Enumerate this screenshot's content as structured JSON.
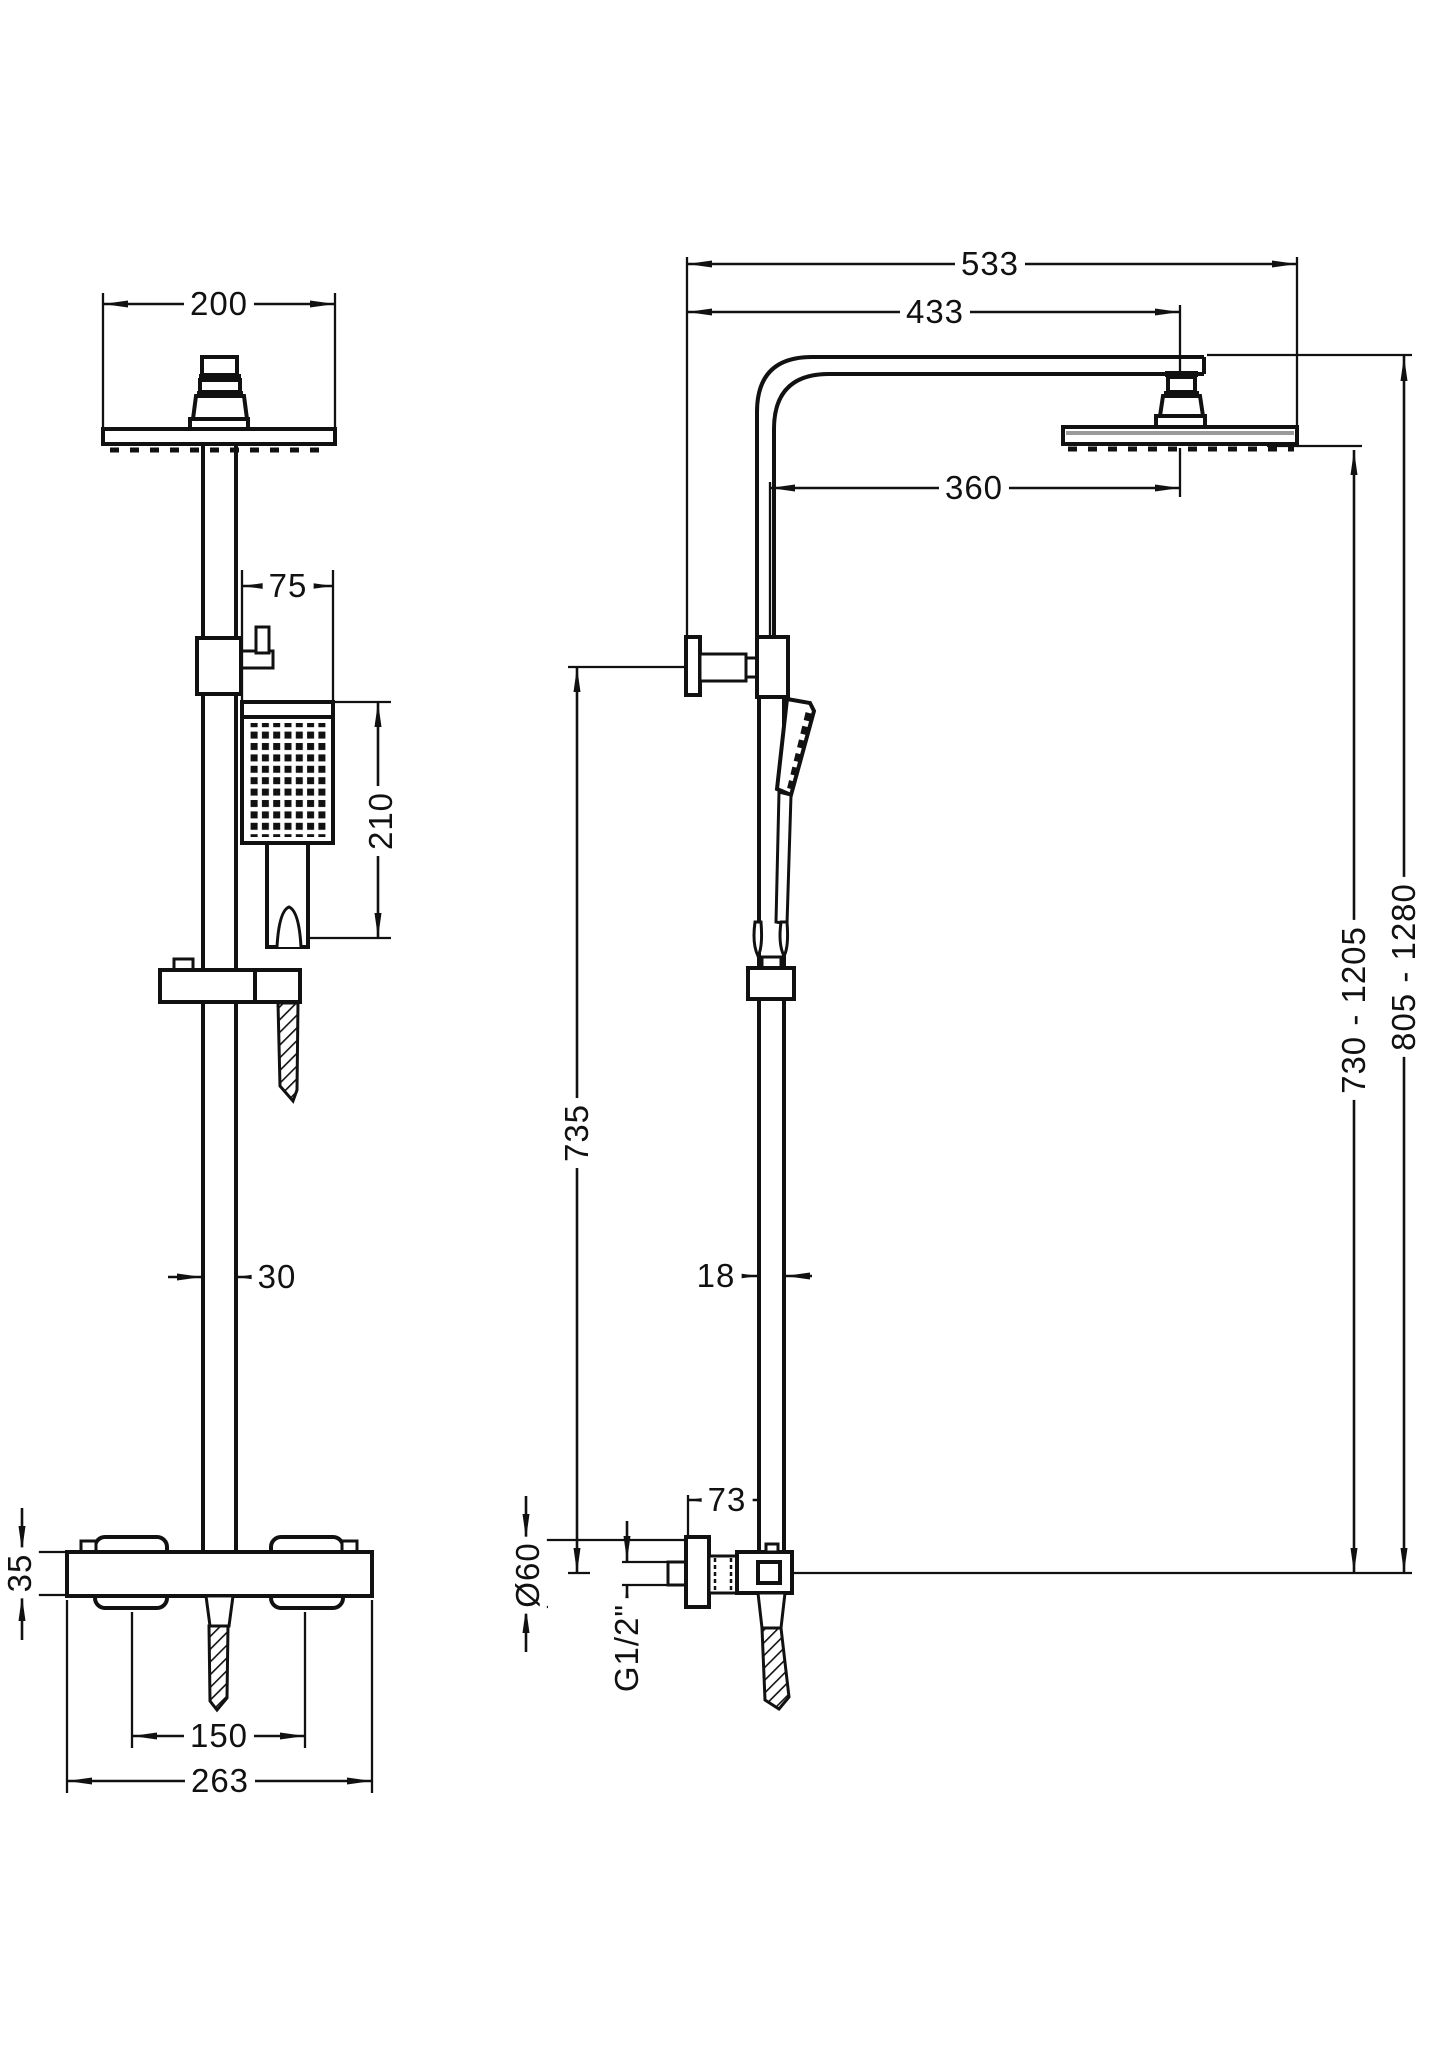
{
  "page": {
    "background": "#ffffff",
    "line_color": "#111111"
  },
  "views": {
    "front": {
      "title": "front-elevation",
      "dims": {
        "head_width": "200",
        "handset_head_width": "75",
        "handset_length": "210",
        "rail_width": "30",
        "valve_body_height": "35",
        "handle_centres": "150",
        "valve_overall_width": "263"
      }
    },
    "side": {
      "title": "side-elevation",
      "dims": {
        "overall_reach": "533",
        "reach_to_head_centre": "433",
        "rail_to_head_centre": "360",
        "bracket_to_valve_centre": "735",
        "rail_depth": "18",
        "wall_to_rail": "73",
        "flange_diameter": "Ø60",
        "inlet_thread": "G1/2\"",
        "valve_to_head_face_range": "730 - 1205",
        "valve_to_arm_top_range": "805 - 1280"
      }
    }
  }
}
